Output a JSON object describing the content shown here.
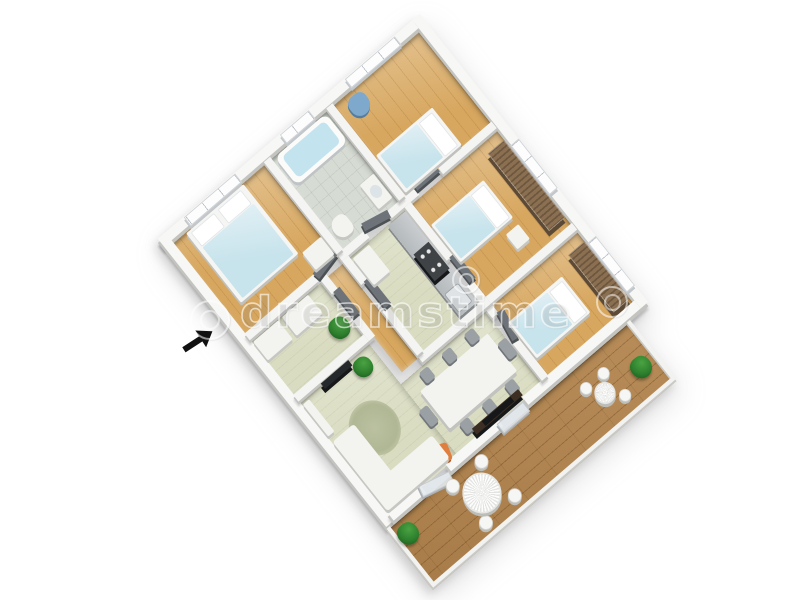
{
  "scene": {
    "description": "3D rendered apartment floor plan, aerial oblique view on white background",
    "background": "#ffffff"
  },
  "watermark": {
    "text": "dreamstime"
  },
  "entrance_arrow": {
    "direction": "up-right",
    "color": "#111111"
  },
  "colors": {
    "wall_top": "#f4f4f2",
    "wall_side": "#c3c3c0",
    "wood_floor": "#d7a75f",
    "pale_floor": "#d9dcc0",
    "tile_floor": "#d6dbd3",
    "deck_floor": "#b78c58",
    "bed_blanket": "#c7e3ec",
    "wardrobe_wood": "#8a6f51",
    "sofa_white": "#f3f3f0",
    "rug_green": "#aeb592",
    "accent_orange": "#e07e3e",
    "plant_green": "#2d7f2d",
    "counter_steel": "#b4b9bc",
    "stove_dark": "#3f4345",
    "door_gray": "#6d7378",
    "water_blue": "#c3e3ef",
    "arrow_black": "#111111"
  },
  "rooms": [
    {
      "name": "bedroom-2",
      "floor": "wood",
      "furniture": [
        "single-bed",
        "blue-chair",
        "window"
      ]
    },
    {
      "name": "bedroom-3",
      "floor": "wood",
      "furniture": [
        "single-bed",
        "wardrobe",
        "nightstand",
        "window"
      ]
    },
    {
      "name": "bedroom-4",
      "floor": "wood",
      "furniture": [
        "single-bed",
        "wardrobe",
        "window"
      ]
    },
    {
      "name": "bathroom",
      "floor": "tile",
      "furniture": [
        "bathtub",
        "washbasin",
        "toilet",
        "window"
      ]
    },
    {
      "name": "kitchen",
      "floor": "pale-green",
      "furniture": [
        "counter",
        "stove",
        "sink",
        "cabinet"
      ]
    },
    {
      "name": "master-bedroom",
      "floor": "wood",
      "furniture": [
        "double-bed",
        "dresser",
        "window"
      ]
    },
    {
      "name": "hallway",
      "floor": "wood",
      "furniture": [
        "doors"
      ]
    },
    {
      "name": "storage-room",
      "floor": "pale-green",
      "furniture": [
        "dresser",
        "dresser",
        "plant"
      ]
    },
    {
      "name": "dining-room",
      "floor": "pale-green",
      "furniture": [
        "dining-table",
        "eight-chairs",
        "media-unit",
        "orange-chair"
      ]
    },
    {
      "name": "living-room",
      "floor": "pale-green",
      "furniture": [
        "corner-sofa",
        "round-rug",
        "tv-panel",
        "sideboard",
        "plant"
      ]
    },
    {
      "name": "balcony",
      "floor": "wood-deck",
      "furniture": [
        "round-table-large",
        "round-table-small",
        "chairs",
        "plant",
        "plant"
      ]
    }
  ]
}
